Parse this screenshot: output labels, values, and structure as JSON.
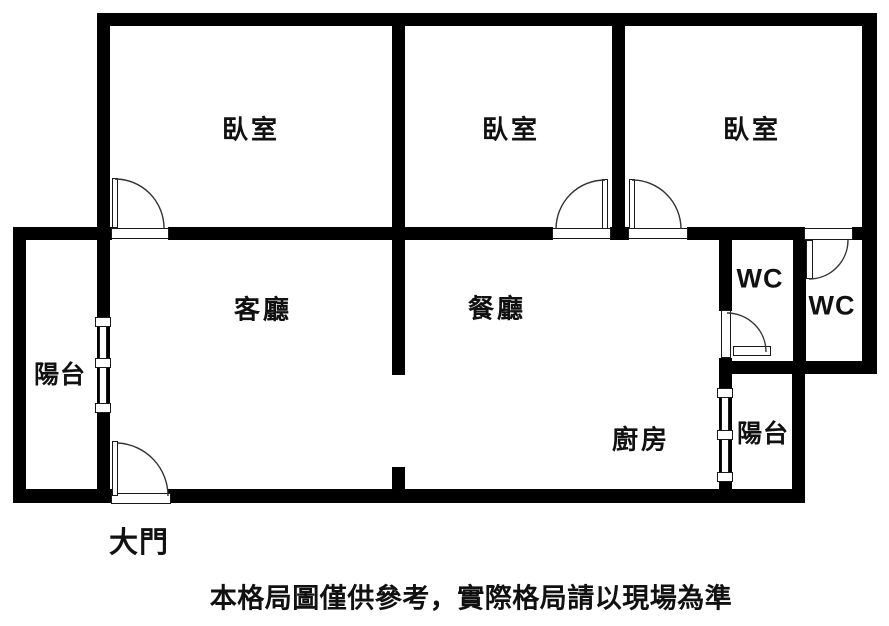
{
  "floor_plan": {
    "rooms": [
      {
        "id": "bedroom-1",
        "label": "臥室"
      },
      {
        "id": "bedroom-2",
        "label": "臥室"
      },
      {
        "id": "bedroom-3",
        "label": "臥室"
      },
      {
        "id": "living-room",
        "label": "客廳"
      },
      {
        "id": "dining-room",
        "label": "餐廳"
      },
      {
        "id": "kitchen",
        "label": "廚房"
      },
      {
        "id": "wc-1",
        "label": "WC"
      },
      {
        "id": "wc-2",
        "label": "WC"
      },
      {
        "id": "balcony-left",
        "label": "陽台"
      },
      {
        "id": "balcony-right",
        "label": "陽台"
      }
    ],
    "entrance_label": "大門",
    "caption": "本格局圖僅供參考，實際格局請以現場為準",
    "colors": {
      "wall": "#000000",
      "background": "#ffffff",
      "text": "#111111"
    }
  }
}
